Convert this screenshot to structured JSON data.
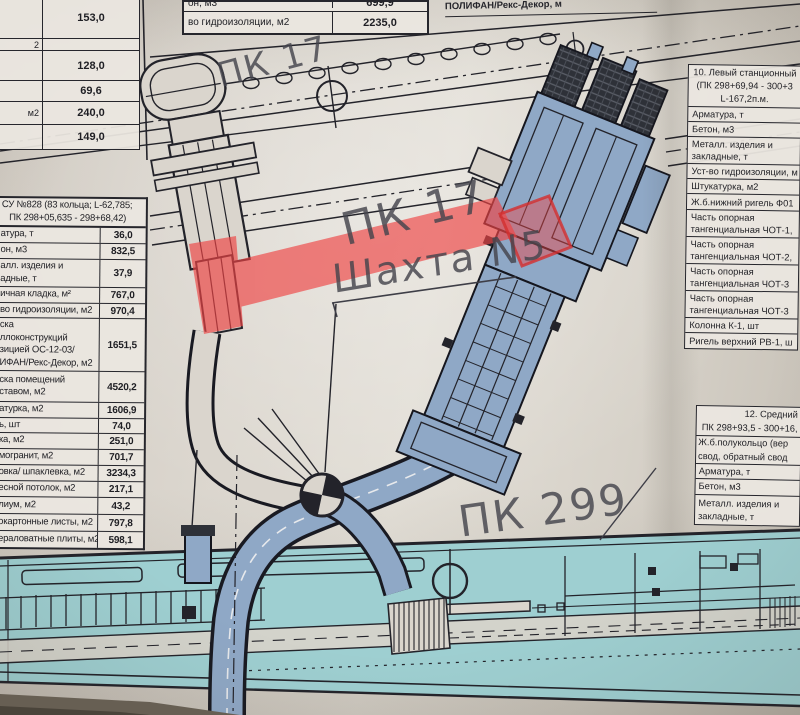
{
  "colors": {
    "ink": "#23232a",
    "paper": "#dad5cd",
    "steel": "#8fa8c6",
    "cyan": "#9ecfd1",
    "red": "#ef4444",
    "hand": "#45454d"
  },
  "handwritten": {
    "pk17_top": "ПК 17",
    "pk17_mid": "ПК 17",
    "shaft_label": "Шахта N5",
    "pk299": "ПК 299"
  },
  "top_left_table": {
    "rows": [
      {
        "label": "",
        "value": "153,0"
      },
      {
        "label": "2",
        "value": ""
      },
      {
        "label": "",
        "value": "128,0"
      },
      {
        "label": "",
        "value": "69,6"
      },
      {
        "label": "м2",
        "value": "240,0"
      },
      {
        "label": "",
        "value": "149,0"
      }
    ]
  },
  "top_middle_table": {
    "rows": [
      {
        "label": "он, м3",
        "value": "699,9"
      },
      {
        "label": "во гидроизоляции, м2",
        "value": "2235,0"
      }
    ]
  },
  "top_right_fragment": {
    "text": "ПОЛИФАН/Рекс-Декор, м"
  },
  "left_table": {
    "title": "СУ №828 (83 кольца; L-62,785;\n   ПК 298+05,635 - 298+68,42)",
    "rows": [
      {
        "label": "атура, т",
        "value": "36,0"
      },
      {
        "label": "он, м3",
        "value": "832,5"
      },
      {
        "label": "алл. изделия и\nадные, т",
        "value": "37,9"
      },
      {
        "label": "ичная кладка, м²",
        "value": "767,0"
      },
      {
        "label": "во гидроизоляции, м2",
        "value": "970,4"
      },
      {
        "label": "ска\nллоконструкций\nзицией ОС-12-03/\nИФАН/Рекс-Декор, м2",
        "value": "1651,5"
      },
      {
        "label": "ска помещений\nставом, м2",
        "value": "4520,2"
      },
      {
        "label": "атурка, м2",
        "value": "1606,9"
      },
      {
        "label": "ь, шт",
        "value": "74,0"
      },
      {
        "label": "ка, м2",
        "value": "251,0"
      },
      {
        "label": "могранит, м2",
        "value": "701,7"
      },
      {
        "label": "овка/ шпаклевка, м2",
        "value": "3234,3"
      },
      {
        "label": "есной потолок, м2",
        "value": "217,1"
      },
      {
        "label": "лиум, м2",
        "value": "43,2"
      },
      {
        "label": "окартонные листы, м2",
        "value": "797,8"
      },
      {
        "label": "ераловатные плиты, м2",
        "value": "598,1"
      }
    ]
  },
  "right_table_10": {
    "title": "10. Левый станционный\n(ПК 298+69,94 - 300+3\nL-167,2п.м.",
    "rows": [
      "Арматура, т",
      "Бетон, м3",
      "Металл. изделия и\nзакладные, т",
      "Уст-во гидроизоляции, м",
      "Штукатурка, м2",
      "Ж.б.нижний ригель Ф01",
      "Часть опорная\nтангенциальная ЧОТ-1,",
      "Часть опорная\nтангенциальная ЧОТ-2,",
      "Часть опорная\nтангенциальная ЧОТ-3",
      "Часть опорная\nтангенциальная ЧОТ-3",
      "Колонна К-1, шт",
      "Ригель верхний РВ-1, ш"
    ]
  },
  "right_table_12": {
    "title": "12. Средний\nПК 298+93,5 - 300+16,",
    "subtitle": "Ж.б.полукольцо (вер\nсвод, обратный свод",
    "rows": [
      "Арматура, т",
      "Бетон, м3",
      "Металл. изделия и\nзакладные, т"
    ]
  }
}
